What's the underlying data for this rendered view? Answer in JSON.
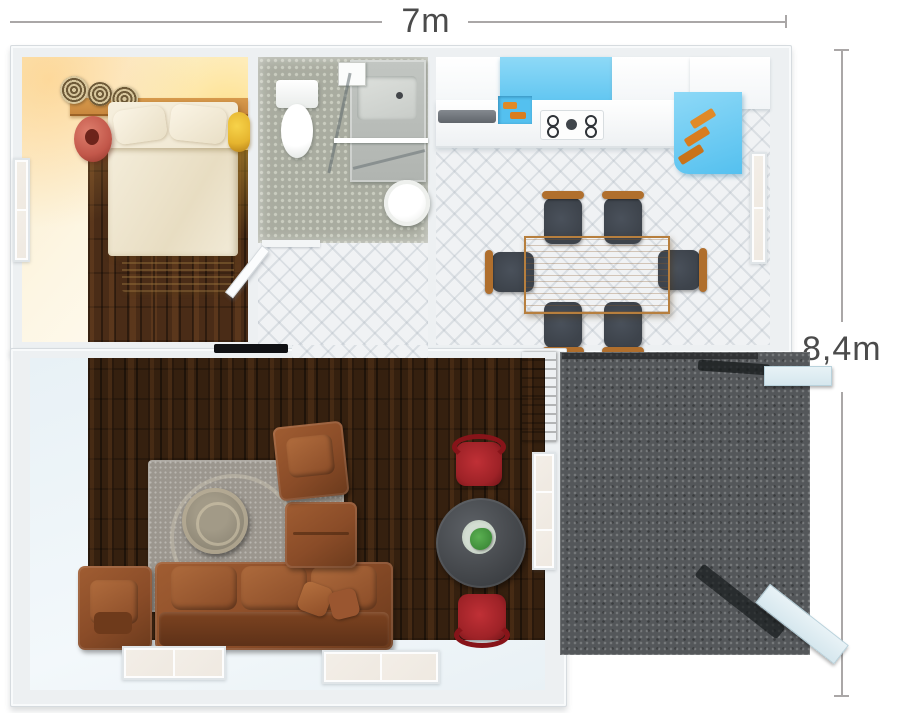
{
  "floor_plan": {
    "width_label": "7m",
    "height_label": "8,4m",
    "rooms": [
      {
        "id": "bedroom",
        "furniture": [
          "double-bed",
          "pillows",
          "foot-bench",
          "headboard-shelf",
          "woven-baskets",
          "coral-vase",
          "yellow-bedside-stool",
          "left-wall-window"
        ]
      },
      {
        "id": "bathroom",
        "furniture": [
          "toilet",
          "vanity-counter-sink",
          "round-basin",
          "glass-shower-partition",
          "towel-bar"
        ]
      },
      {
        "id": "hallway",
        "furniture": [
          "open-door"
        ]
      },
      {
        "id": "kitchen-dining",
        "furniture": [
          "white-counter",
          "blue-cabinets",
          "gas-cooktop",
          "open-shelves-with-dishes",
          "dining-table",
          "dining-chairs"
        ],
        "dining_chair_count": 6
      },
      {
        "id": "living-room",
        "furniture": [
          "sectional-leather-sofa",
          "leather-armchair-top",
          "leather-armchair-left",
          "gray-rug",
          "round-coffee-table",
          "bistro-table",
          "red-chairs",
          "plant",
          "wall-tv",
          "bottom-windows",
          "right-wall-window",
          "terrace-door"
        ],
        "red_chair_count": 2,
        "bottom_window_count": 2
      },
      {
        "id": "terrace",
        "furniture": [
          "open-ramp-door-top",
          "open-ramp-door-bottom"
        ]
      }
    ]
  },
  "colors": {
    "dim_text": "#4b4b4b",
    "dim_line": "#aaa7a7",
    "wall": "#edf0f2",
    "marble_floor": "#f0f2f4",
    "bedroom_floor": "#4a2c17",
    "living_floor": "#35200f",
    "bathroom_floor": "#a9aca0",
    "terrace_gray": "#54575a",
    "bedroom_wall_tint": "#fbeccb",
    "bed_linen": "#efe7d2",
    "bench_wood": "#dcc49c",
    "shelf_wood": "#c9873e",
    "vase_coral": "#c2574a",
    "stool_yellow": "#e5b42e",
    "kitchen_blue": "#54c0ef",
    "kitchen_blue_light": "#8ed9f7",
    "table_oak": "#c9914e",
    "chair_seat_gray": "#3d434b",
    "chair_wood": "#b06f2d",
    "rug_gray": "#9b968e",
    "leather_brown": "#8a4c28",
    "bistro_table_gray": "#45484c",
    "chair_red": "#9e2227",
    "plant_green": "#3f8d3a",
    "ramp_blue": "#d6e7ee",
    "door_wood": "#8a6a33",
    "ice_floor": "#e8f1f6"
  }
}
